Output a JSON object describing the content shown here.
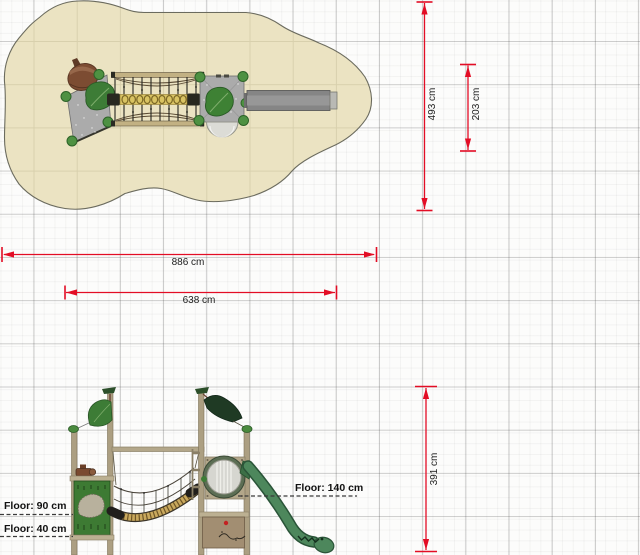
{
  "top_view": {
    "dimensions": {
      "outer_width": "886 cm",
      "inner_width": "638 cm",
      "outer_depth": "493 cm",
      "inner_depth": "203 cm"
    }
  },
  "side_view": {
    "dimensions": {
      "height": "391 cm"
    },
    "floor_labels": [
      "Floor: 140 cm",
      "Floor: 90 cm",
      "Floor: 40 cm"
    ]
  },
  "colors": {
    "dimension_red": "#e30d25",
    "safety_zone_beige": "#ebe3c2",
    "zone_grid_line": "#d8d0ad",
    "page_grid_line": "#c4c4c4",
    "platform_gray": "#ababab",
    "leaf_green": "#3d7c36",
    "dark_leaf_green": "#1f3a24",
    "bush_green": "#4e9142",
    "post_tan": "#ac9f82",
    "rail_tan": "#c2b183",
    "panel_green": "#3d7a33",
    "slide_side_green": "#4d875c",
    "slide_top_gray": "#858585",
    "acorn_brown": "#7c4c32",
    "walkway_yellow": "#d9c363",
    "porthole_silver": "#d6d6d0",
    "lower_panel_brown": "#a28e72"
  }
}
